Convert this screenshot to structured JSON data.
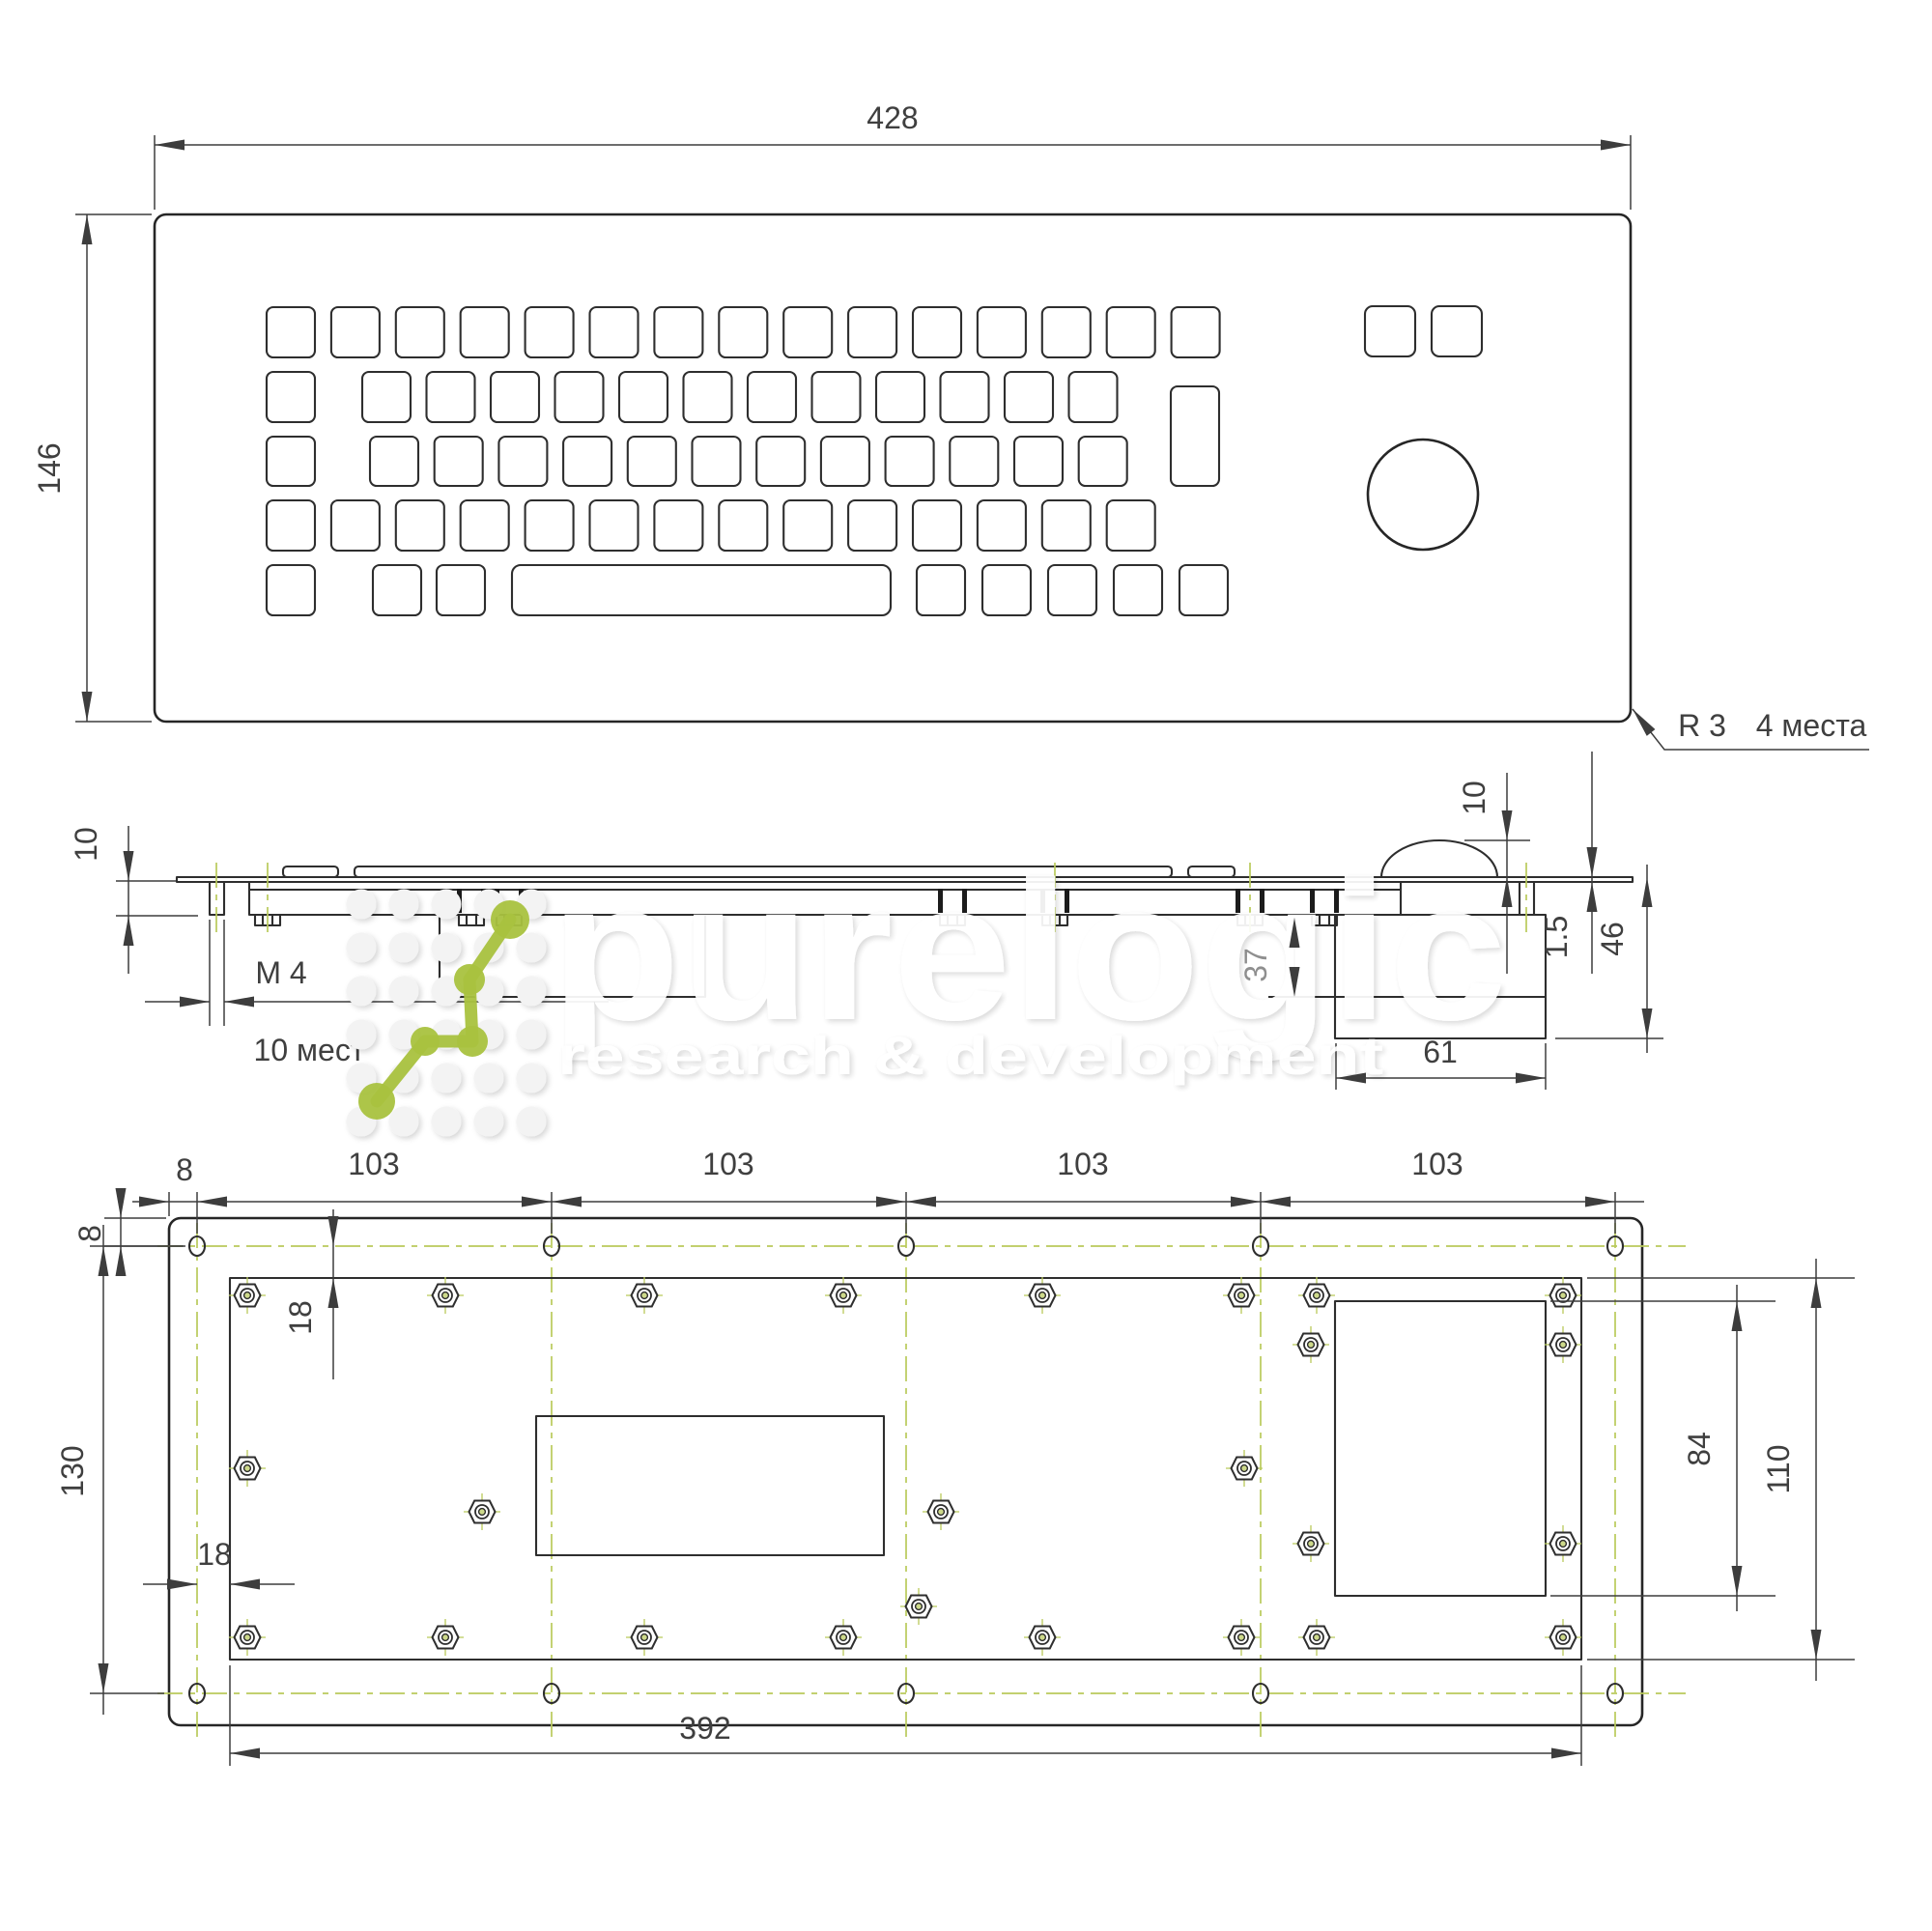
{
  "colors": {
    "line": "#262626",
    "dimension": "#3d3d3d",
    "centerline_green": "#b9ca5b",
    "watermark_green": "#a9c23f",
    "watermark_text": "#ffffff",
    "gray_dimension": "#9a9a9a"
  },
  "views": {
    "front": {
      "width": "428",
      "height": "146",
      "corner_radius": "R 3",
      "corner_places": "4 места"
    },
    "side": {
      "frame_depth": "10",
      "thread": "M 4",
      "thread_places": "10 мест",
      "dome_height": "10",
      "sheet_thickness": "1.5",
      "total_depth": "46",
      "housing_depth": "37",
      "housing_width": "61"
    },
    "bottom": {
      "edge_offset_h": "8",
      "hole_pitch": [
        "103",
        "103",
        "103",
        "103"
      ],
      "edge_offset_v": "8",
      "hole_span": "130",
      "plate_offset_v": "18",
      "plate_offset_h": "18",
      "box_height": "84",
      "plate_height": "110",
      "plate_width": "392"
    }
  },
  "watermark": {
    "brand": "purelogic",
    "tagline": "research & development"
  }
}
